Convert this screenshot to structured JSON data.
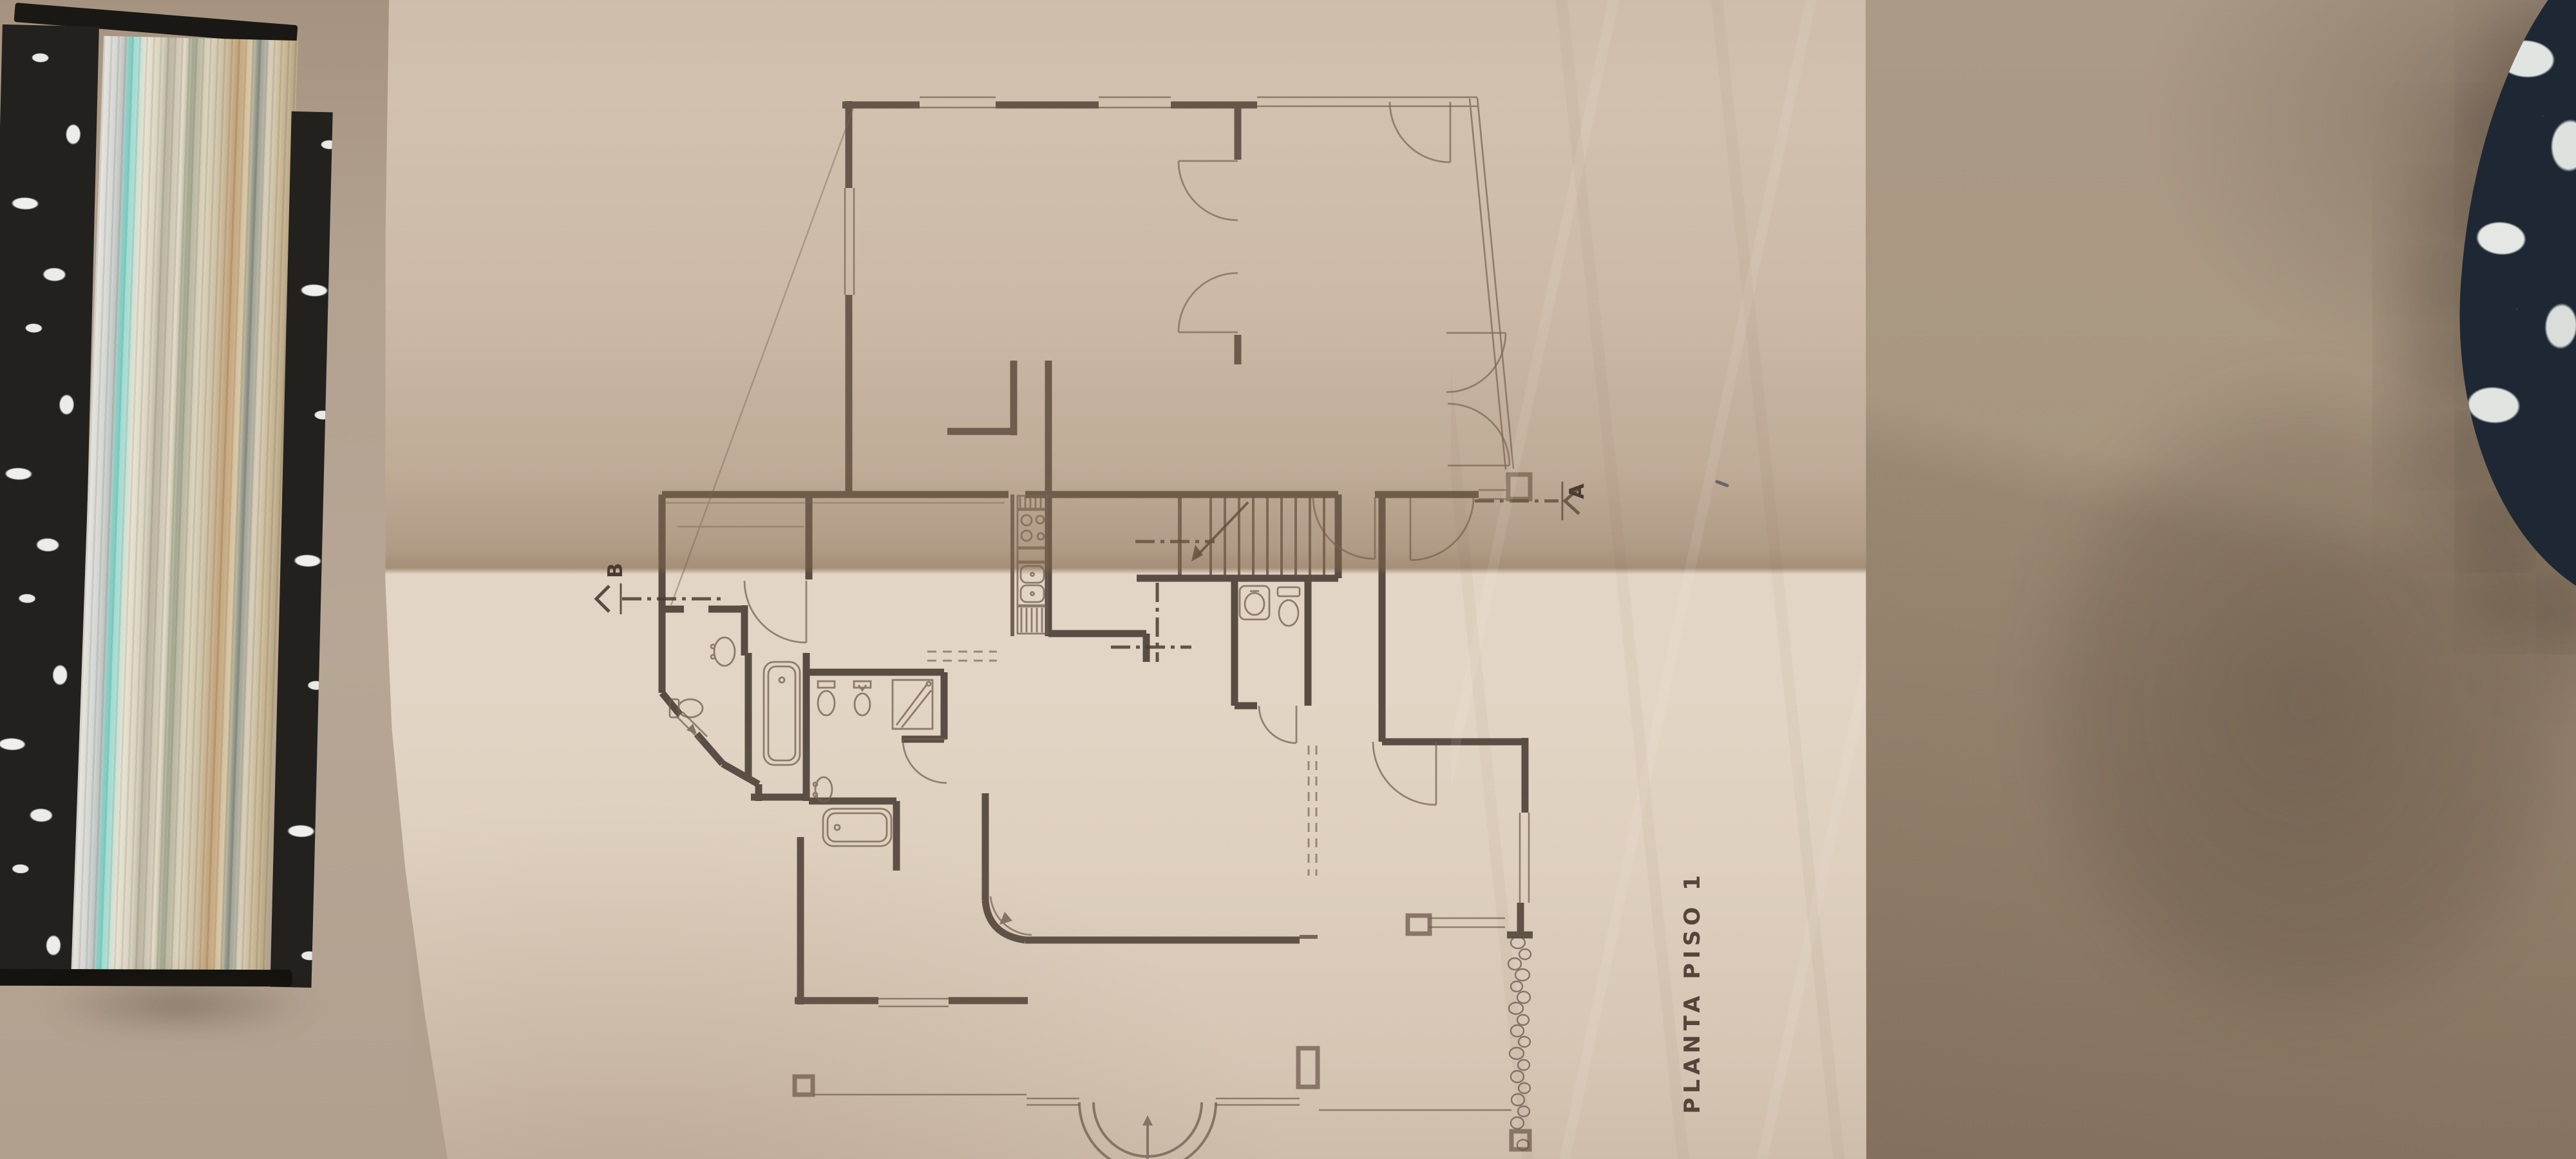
{
  "drawing": {
    "title": "PLANTA PISO 1",
    "section_a_label": "A",
    "section_b_label": "B",
    "fixtures": [
      "staircase",
      "bathtub",
      "toilet",
      "bidet",
      "shower",
      "washbasin",
      "kitchen-stove",
      "kitchen-sink",
      "stone-wall",
      "entrance-step"
    ]
  },
  "objects": {
    "left": "binder-with-stacked-papers",
    "center": "folded-floor-plan-sheet",
    "right": "floral-upholstered-chair-back",
    "background": "beige-wall"
  },
  "colors": {
    "wall": "#b2a08e",
    "paper_light": "#e3d5c5",
    "paper_shaded": "#ad9880",
    "ink": "#4a3b32",
    "binder_cover": "#23211d",
    "binder_marble_spots": "#e9e9e6",
    "chair_fabric": "#1d2834",
    "chair_pattern": "#e1e5e2",
    "pen_mark": "#2b3a66"
  }
}
